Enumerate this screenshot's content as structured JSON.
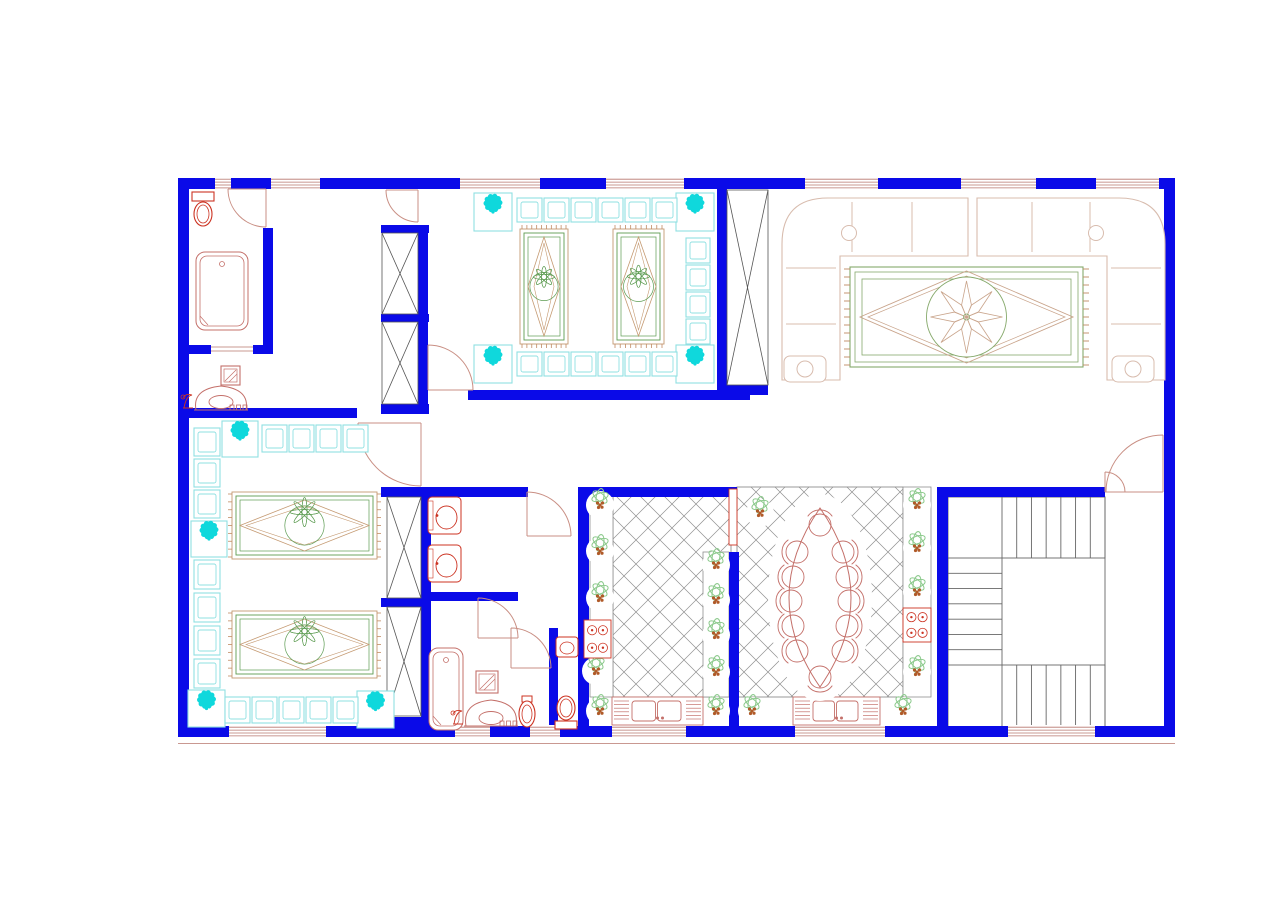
{
  "title": "Floor Plan",
  "plan": {
    "canvas": {
      "w": 1280,
      "h": 897
    },
    "palette": {
      "wall": "#0a0ae8",
      "red": "#cc3322",
      "salmon": "#c4706a",
      "door": "#c98f84",
      "winline": "#b7766d",
      "sofa": "#d8bcae",
      "rug_green": "#86a96b",
      "rug_tan": "#c9a48b",
      "carpet_green": "#5d9c52",
      "carpet_tan": "#c59a72",
      "fringe": "#c08a62",
      "cyan": "#0fd8dc",
      "cyan_light": "#8fe0e2",
      "plant_green": "#8fcb8f",
      "plant_core": "#b05a28",
      "lattice": "#8f8f8f",
      "dark": "#555555",
      "stair": "#666666"
    },
    "lattice_step": 24,
    "window_h": 13,
    "walls": [
      [
        178,
        178,
        997,
        11,
        "outer-top"
      ],
      [
        178,
        726,
        997,
        11,
        "outer-bottom"
      ],
      [
        178,
        178,
        11,
        559,
        "outer-left"
      ],
      [
        1164,
        178,
        11,
        559,
        "outer-right"
      ],
      [
        263,
        228,
        10,
        117,
        "bathroom1-east"
      ],
      [
        189,
        345,
        22,
        9,
        "washroom-north-a"
      ],
      [
        253,
        345,
        20,
        9,
        "washroom-north-b"
      ],
      [
        189,
        408,
        168,
        10,
        "majlis2-north"
      ],
      [
        381,
        404,
        48,
        10,
        "closet1-south-cap"
      ],
      [
        418,
        228,
        10,
        180,
        "bedroom-east"
      ],
      [
        381,
        225,
        48,
        8,
        "closet1-north-cap"
      ],
      [
        381,
        314,
        48,
        8,
        "closet1-mid-cap"
      ],
      [
        468,
        390,
        282,
        10,
        "majlis1-south"
      ],
      [
        717,
        189,
        10,
        201,
        "majlis1-east"
      ],
      [
        717,
        385,
        51,
        10,
        "duct-south-cap"
      ],
      [
        381,
        487,
        147,
        10,
        "hall-south"
      ],
      [
        578,
        487,
        159,
        10,
        "kitchen-north"
      ],
      [
        937,
        487,
        168,
        10,
        "stairhall-north"
      ],
      [
        421,
        487,
        10,
        250,
        "hall-closet-east"
      ],
      [
        381,
        598,
        50,
        9,
        "hall-closet-mid-cap"
      ],
      [
        381,
        717,
        50,
        9,
        "hall-closet-south-cap"
      ],
      [
        431,
        592,
        87,
        9,
        "ablution-south"
      ],
      [
        549,
        628,
        9,
        109,
        "toilet-stall-west"
      ],
      [
        578,
        487,
        11,
        250,
        "kitchen-west"
      ],
      [
        729,
        552,
        10,
        175,
        "kitchen-dining-partition"
      ],
      [
        937,
        487,
        11,
        250,
        "dining-east"
      ]
    ],
    "windows": [
      [
        215,
        177,
        16
      ],
      [
        271,
        177,
        49
      ],
      [
        460,
        177,
        80
      ],
      [
        606,
        177,
        78
      ],
      [
        805,
        177,
        73
      ],
      [
        961,
        177,
        75
      ],
      [
        1096,
        177,
        63
      ],
      [
        229,
        725,
        97
      ],
      [
        455,
        725,
        35
      ],
      [
        530,
        725,
        30
      ],
      [
        612,
        725,
        74
      ],
      [
        795,
        725,
        90
      ],
      [
        1008,
        725,
        87
      ]
    ],
    "doors": [
      [
        266,
        189,
        38,
        180,
        90,
        0,
        "bathroom1-door"
      ],
      [
        418,
        190,
        32,
        180,
        90,
        0,
        "bedroom-door"
      ],
      [
        428,
        390,
        45,
        270,
        360,
        1,
        "majlis1-door"
      ],
      [
        421,
        423,
        63,
        180,
        90,
        0,
        "majlis2-door"
      ],
      [
        527,
        536,
        44,
        270,
        360,
        1,
        "ablution-door"
      ],
      [
        478,
        638,
        40,
        270,
        360,
        1,
        "bathroom2-door"
      ],
      [
        511,
        668,
        40,
        270,
        360,
        1,
        "toilet-stall-door"
      ],
      [
        1163,
        492,
        57,
        180,
        270,
        1,
        "entry-door-main-leaf"
      ],
      [
        1105,
        492,
        20,
        0,
        -90,
        0,
        "entry-door-small-leaf"
      ]
    ],
    "niches": [
      [
        729,
        489,
        8,
        56
      ]
    ],
    "thin_lines": [
      [
        211,
        347,
        253,
        347
      ],
      [
        211,
        351,
        253,
        351
      ],
      [
        178,
        743.5,
        1175,
        743.5
      ]
    ],
    "xboxes": [
      [
        382,
        233,
        36,
        81,
        "bedroom-closet-upper"
      ],
      [
        382,
        322,
        36,
        82,
        "bedroom-closet-lower"
      ],
      [
        727,
        190,
        41,
        195,
        "duct-shaft"
      ],
      [
        387,
        497,
        34,
        101,
        "hall-closet-upper"
      ],
      [
        387,
        607,
        34,
        109,
        "hall-closet-lower"
      ]
    ],
    "lattices": [
      [
        613,
        495,
        118,
        202,
        "kitchen-floor"
      ],
      [
        737,
        487,
        166,
        210,
        "dining-floor"
      ]
    ],
    "strips": [
      [
        590,
        495,
        23,
        202
      ],
      [
        703,
        552,
        26,
        145
      ],
      [
        903,
        487,
        28,
        210
      ]
    ],
    "stairs": {
      "box": [
        948,
        497,
        157,
        230
      ],
      "runs": [
        [
          1002,
          497,
          103,
          61,
          "v",
          6
        ],
        [
          948,
          558,
          54,
          107,
          "h",
          6
        ],
        [
          1002,
          665,
          103,
          62,
          "v",
          6
        ]
      ]
    },
    "flower_boxes": [
      [
        474,
        193,
        38
      ],
      [
        676,
        193,
        38
      ],
      [
        474,
        345,
        38
      ],
      [
        676,
        345,
        38
      ],
      [
        222,
        421,
        36
      ],
      [
        191,
        521,
        36
      ],
      [
        188,
        690,
        37
      ],
      [
        357,
        691,
        37
      ]
    ],
    "cushion_rows": [
      [
        517,
        198,
        6,
        27,
        0,
        25,
        24
      ],
      [
        517,
        352,
        6,
        27,
        0,
        25,
        24
      ],
      [
        686,
        238,
        4,
        0,
        27,
        24,
        25
      ],
      [
        262,
        425,
        4,
        27,
        0,
        25,
        27
      ],
      [
        194,
        428,
        3,
        0,
        31,
        26,
        28
      ],
      [
        194,
        560,
        4,
        0,
        33,
        26,
        29
      ],
      [
        225,
        697,
        5,
        27,
        0,
        25,
        26
      ]
    ],
    "carpets": [
      [
        520,
        229,
        48,
        115,
        "v"
      ],
      [
        613,
        229,
        51,
        115,
        "v"
      ],
      [
        232,
        492,
        145,
        67,
        "h"
      ],
      [
        232,
        611,
        145,
        67,
        "h"
      ]
    ],
    "rug": [
      850,
      267,
      233,
      100
    ],
    "sofas": [
      {
        "corner": "tl",
        "x": 782,
        "y": 198,
        "rw": 186,
        "rh": 182,
        "depth": 58,
        "div_h": [
          852,
          912
        ],
        "div_v": [
          268,
          324
        ],
        "lamp": [
          849,
          233
        ],
        "table": [
          784,
          356,
          42,
          26
        ]
      },
      {
        "corner": "tr",
        "x": 977,
        "y": 198,
        "rw": 188,
        "rh": 182,
        "depth": 58,
        "div_h": [
          1032,
          1090
        ],
        "div_v": [
          268,
          324
        ],
        "lamp": [
          1096,
          233
        ],
        "table": [
          1112,
          356,
          42,
          26
        ]
      }
    ],
    "plants": [
      [
        600,
        505
      ],
      [
        600,
        551
      ],
      [
        600,
        598
      ],
      [
        596,
        671
      ],
      [
        600,
        711
      ],
      [
        716,
        565
      ],
      [
        716,
        600
      ],
      [
        716,
        635
      ],
      [
        716,
        672
      ],
      [
        716,
        711
      ],
      [
        760,
        513
      ],
      [
        752,
        711
      ],
      [
        917,
        505
      ],
      [
        917,
        548
      ],
      [
        917,
        592
      ],
      [
        917,
        672
      ],
      [
        903,
        711
      ]
    ],
    "stoves": [
      [
        584,
        620,
        27,
        38
      ],
      [
        903,
        608,
        28,
        34
      ]
    ],
    "sink_counters": [
      [
        612,
        697,
        91,
        28
      ],
      [
        793,
        697,
        87,
        28
      ]
    ],
    "toilets": [
      [
        203,
        192,
        "tank-top"
      ],
      [
        527,
        696,
        "bidet"
      ],
      [
        566,
        696,
        "tank-bottom"
      ]
    ],
    "tubs": [
      [
        196,
        252,
        52,
        78
      ],
      [
        429,
        648,
        34,
        82
      ]
    ],
    "wall_basins": [
      [
        428,
        497,
        33,
        37
      ],
      [
        428,
        545,
        33,
        37
      ]
    ],
    "corner_basin": [
      556,
      637,
      22,
      20
    ],
    "mirrors": [
      [
        221,
        366,
        19
      ],
      [
        476,
        671,
        22
      ]
    ],
    "vanities": [
      [
        192,
        386,
        58,
        24
      ],
      [
        462,
        700,
        58,
        26
      ]
    ],
    "dining_table": {
      "cx": 820,
      "y_top": 508,
      "y_bottom": 687,
      "half_w": 31,
      "chair_r": 11,
      "chairs": [
        [
          820,
          525,
          "n"
        ],
        [
          797,
          552,
          "w"
        ],
        [
          793,
          577,
          "w"
        ],
        [
          791,
          601,
          "w"
        ],
        [
          793,
          626,
          "w"
        ],
        [
          797,
          651,
          "w"
        ],
        [
          843,
          552,
          "e"
        ],
        [
          847,
          577,
          "e"
        ],
        [
          849,
          601,
          "e"
        ],
        [
          847,
          626,
          "e"
        ],
        [
          843,
          651,
          "e"
        ],
        [
          820,
          677,
          "s"
        ]
      ]
    },
    "rooms": [
      {
        "name": "bathroom-1"
      },
      {
        "name": "washroom"
      },
      {
        "name": "bedroom"
      },
      {
        "name": "majlis-1"
      },
      {
        "name": "living-room"
      },
      {
        "name": "majlis-2"
      },
      {
        "name": "ablution-room"
      },
      {
        "name": "bathroom-2"
      },
      {
        "name": "toilet-stall"
      },
      {
        "name": "kitchen"
      },
      {
        "name": "dining-room"
      },
      {
        "name": "stair-hall"
      }
    ]
  }
}
